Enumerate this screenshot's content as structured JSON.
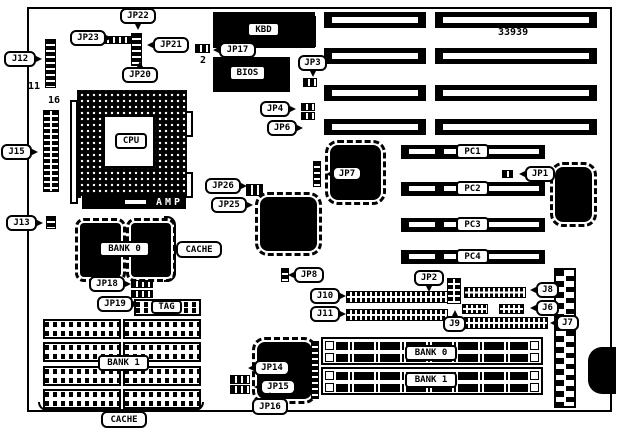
{
  "diagram": {
    "part_number": "33939",
    "callouts": {
      "j12": "J12",
      "jp23": "JP23",
      "jp22": "JP22",
      "jp21": "JP21",
      "jp20": "JP20",
      "jp17": "JP17",
      "jp3": "JP3",
      "jp4": "JP4",
      "jp6": "JP6",
      "j15": "J15",
      "j13": "J13",
      "jp26": "JP26",
      "jp25": "JP25",
      "jp7": "JP7",
      "jp1": "JP1",
      "jp2": "JP2",
      "jp8": "JP8",
      "j10": "J10",
      "j11": "J11",
      "j9": "J9",
      "j8": "J8",
      "j6": "J6",
      "j7": "J7",
      "jp18": "JP18",
      "jp19": "JP19",
      "jp14": "JP14",
      "jp15": "JP15",
      "jp16": "JP16",
      "cache_top": "CACHE",
      "cache_bottom": "CACHE"
    },
    "plates": {
      "kbd": "KBD",
      "bios": "BIOS",
      "cpu": "CPU",
      "amp": "AMP",
      "bank0_cache": "BANK 0",
      "tag": "TAG",
      "bank1_cache": "BANK 1",
      "pc1": "PC1",
      "pc2": "PC2",
      "pc3": "PC3",
      "pc4": "PC4",
      "bank0_simm": "BANK 0",
      "bank1_simm": "BANK 1"
    },
    "pin_numbers": {
      "j12_pins": "11",
      "j15_pins": "16",
      "jp17_pin": "2"
    }
  }
}
